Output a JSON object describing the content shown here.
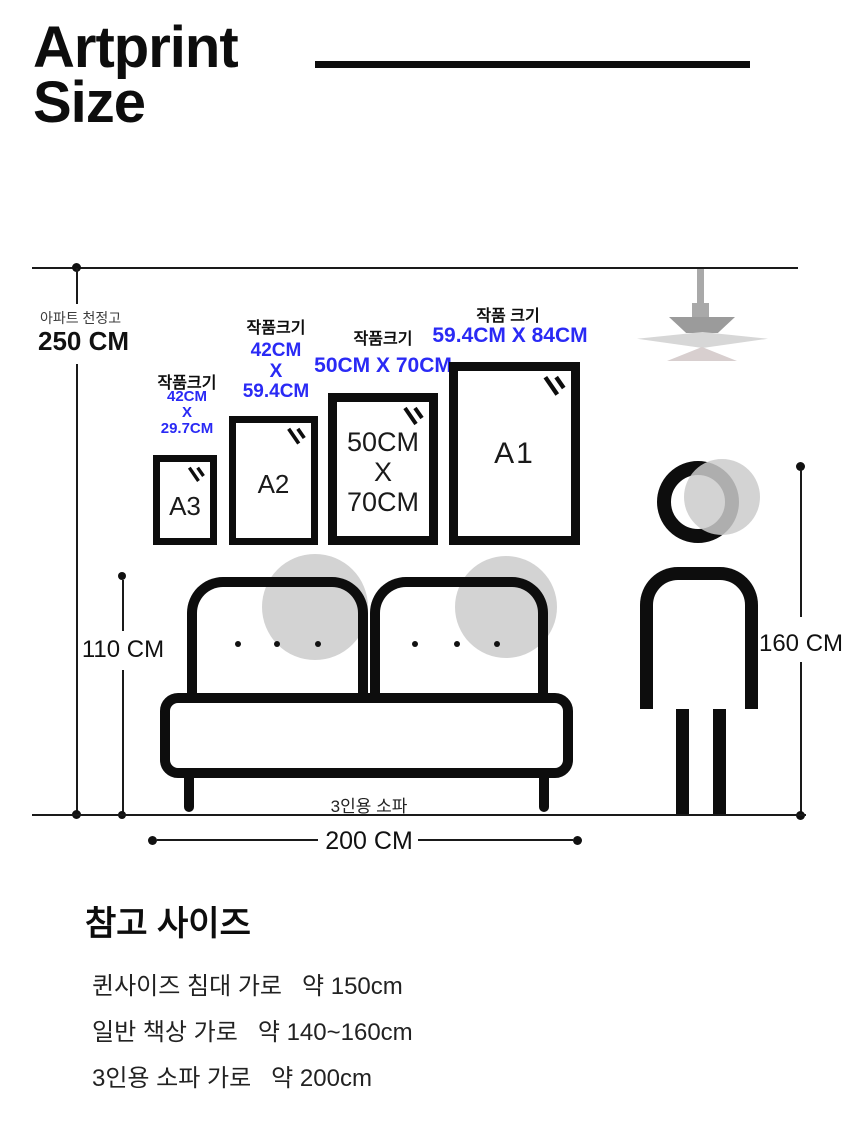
{
  "title": {
    "line1": "Artprint",
    "line2": "Size"
  },
  "ceiling": {
    "caption": "아파트 천정고",
    "value": "250 CM"
  },
  "frames": {
    "a3": {
      "label": "작품크기",
      "dim_l1": "42CM",
      "dim_l2": "X",
      "dim_l3": "29.7CM",
      "name": "A3"
    },
    "a2": {
      "label": "작품크기",
      "dim_l1": "42CM",
      "dim_l2": "X",
      "dim_l3": "59.4CM",
      "name": "A2"
    },
    "f50": {
      "label": "작품크기",
      "dim": "50CM X 70CM",
      "inner_l1": "50CM",
      "inner_l2": "X",
      "inner_l3": "70CM"
    },
    "a1": {
      "label": "작품 크기",
      "dim": "59.4CM X 84CM",
      "name": "A1"
    }
  },
  "dimensions": {
    "ceiling_height": "250 CM",
    "sofa_height": "110 CM",
    "sofa_width": "200 CM",
    "person_height": "160 CM"
  },
  "sofa": {
    "label": "3인용 소파"
  },
  "reference": {
    "heading": "참고 사이즈",
    "item1": "퀸사이즈 침대 가로   약 150cm",
    "item2": "일반 책상 가로   약 140~160cm",
    "item3": "3인용 소파 가로   약 200cm"
  },
  "colors": {
    "accent_blue": "#2a2af5",
    "ink": "#111111",
    "shape_gray": "#d3d3d3",
    "lamp_dark": "#9b9b9b",
    "lamp_light": "#d7d7d7"
  }
}
